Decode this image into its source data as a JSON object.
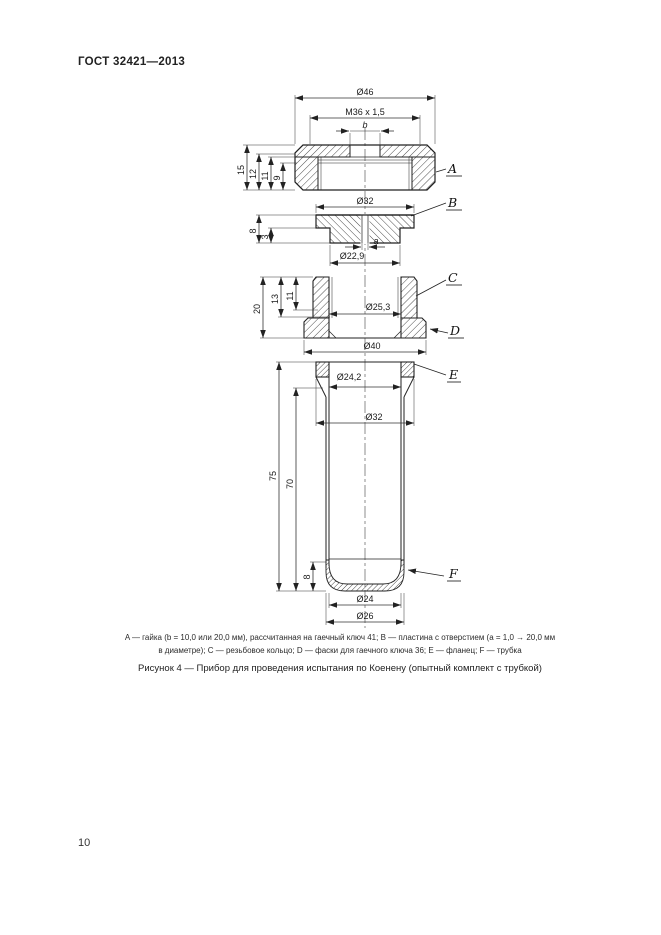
{
  "page": {
    "header": "ГОСТ 32421—2013",
    "page_number": "10"
  },
  "figure": {
    "caption_line1": "A — гайка (b = 10,0 или 20,0 мм), рассчитанная на гаечный ключ 41; B — пластина с отверстием (a = 1,0 → 20,0 мм",
    "caption_line2": "в диаметре); C — резьбовое кольцо; D — фаски для гаечного ключа 36; E — фланец; F — трубка",
    "title": "Рисунок 4 — Прибор для проведения испытания по Коенену (опытный комплект с трубкой)"
  },
  "drawing": {
    "labels": {
      "A": "A",
      "B": "B",
      "C": "C",
      "D": "D",
      "E": "E",
      "F": "F"
    },
    "dims": {
      "d46": "Ø46",
      "m36": "M36 x 1,5",
      "b": "b",
      "n15": "15",
      "n12": "12",
      "n11": "11",
      "n9": "9",
      "d32_plate": "Ø32",
      "n8": "8",
      "n3": "3",
      "a": "a",
      "d22_9": "Ø22,9",
      "n20": "20",
      "n13": "13",
      "n11c": "11",
      "d25_3": "Ø25,3",
      "d40": "Ø40",
      "d24_2": "Ø24,2",
      "d32_flange": "Ø32",
      "n75": "75",
      "n70": "70",
      "n8f": "8",
      "d24": "Ø24",
      "d26": "Ø26"
    }
  }
}
